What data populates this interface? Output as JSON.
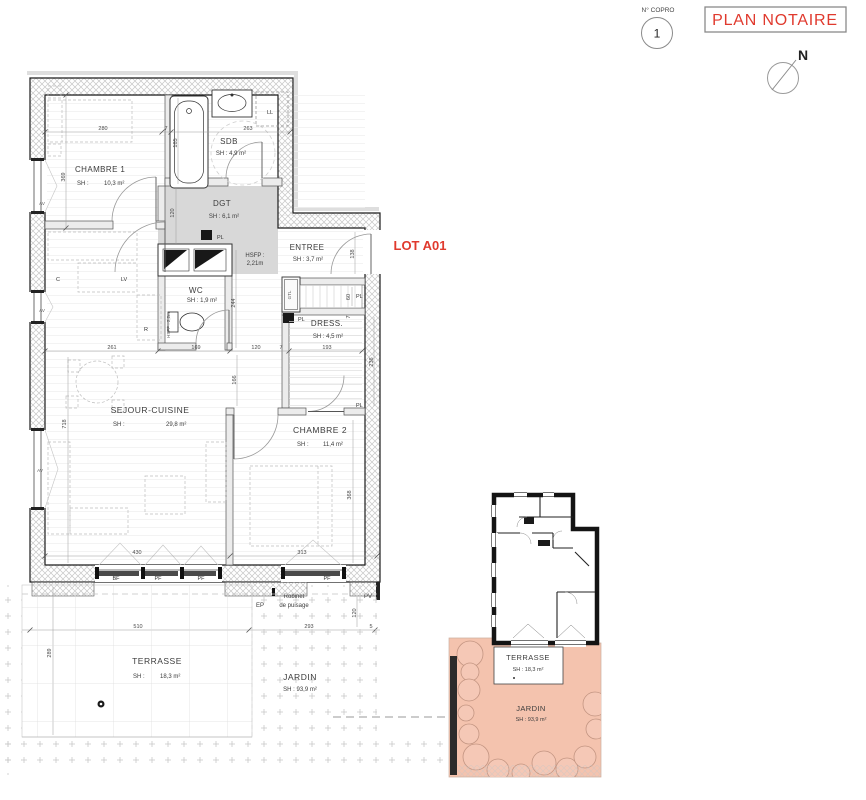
{
  "header": {
    "copro_label": "N° COPRO",
    "copro_number": "1",
    "title": "PLAN NOTAIRE",
    "north": "N"
  },
  "lot": {
    "label": "LOT A01"
  },
  "rooms": {
    "chambre1": {
      "name": "CHAMBRE 1",
      "sh": "SH :",
      "area": "10,3 m²"
    },
    "sdb": {
      "name": "SDB",
      "area": "SH : 4,9 m²"
    },
    "dgt": {
      "name": "DGT",
      "area": "SH : 6,1 m²"
    },
    "entree": {
      "name": "ENTREE",
      "area": "SH : 3,7 m²"
    },
    "wc": {
      "name": "WC",
      "area": "SH : 1,9 m²"
    },
    "dress": {
      "name": "DRESS.",
      "area": "SH : 4,5 m²"
    },
    "sejour": {
      "name": "SEJOUR-CUISINE",
      "sh": "SH :",
      "area": "29,8 m²"
    },
    "chambre2": {
      "name": "CHAMBRE 2",
      "sh": "SH :",
      "area": "11,4 m²"
    },
    "terrasse": {
      "name": "TERRASSE",
      "sh": "SH :",
      "area": "18,3 m²"
    },
    "jardin": {
      "name": "JARDIN",
      "area": "SH : 93,9 m²"
    }
  },
  "keyplan": {
    "terrasse_name": "TERRASSE",
    "terrasse_area": "SH : 18,3 m²",
    "jardin_name": "JARDIN",
    "jardin_area": "SH : 93,9 m²"
  },
  "annotations": {
    "hsfp_label": "HSFP :",
    "hsfp_value": "2,21m",
    "hsfp_wc": "HSFP : 2,2m",
    "ll": "LL",
    "lv": "LV",
    "c": "C",
    "r": "R",
    "gtl": "GTL",
    "pl": "PL",
    "av": "AV",
    "bf": "BF",
    "pf": "PF",
    "ep": "EP",
    "pv": "PV",
    "robinet_line1": "Robinet",
    "robinet_line2": "de puisage"
  },
  "dims": {
    "d280": "280",
    "d7": "7",
    "d263": "263",
    "d185": "185",
    "d369": "369",
    "d120": "120",
    "d244": "244",
    "d261": "261",
    "d169": "169",
    "d193": "193",
    "d138": "138",
    "d60": "60",
    "d236": "236",
    "d166": "166",
    "d718": "718",
    "d430": "430",
    "d313": "313",
    "d368": "368",
    "d510": "510",
    "d293": "293",
    "d289": "289",
    "d5": "5"
  },
  "colors": {
    "accent_red": "#e03a2e",
    "salmon": "#f4c3ae",
    "dgt_gray": "#d8d8d8"
  }
}
